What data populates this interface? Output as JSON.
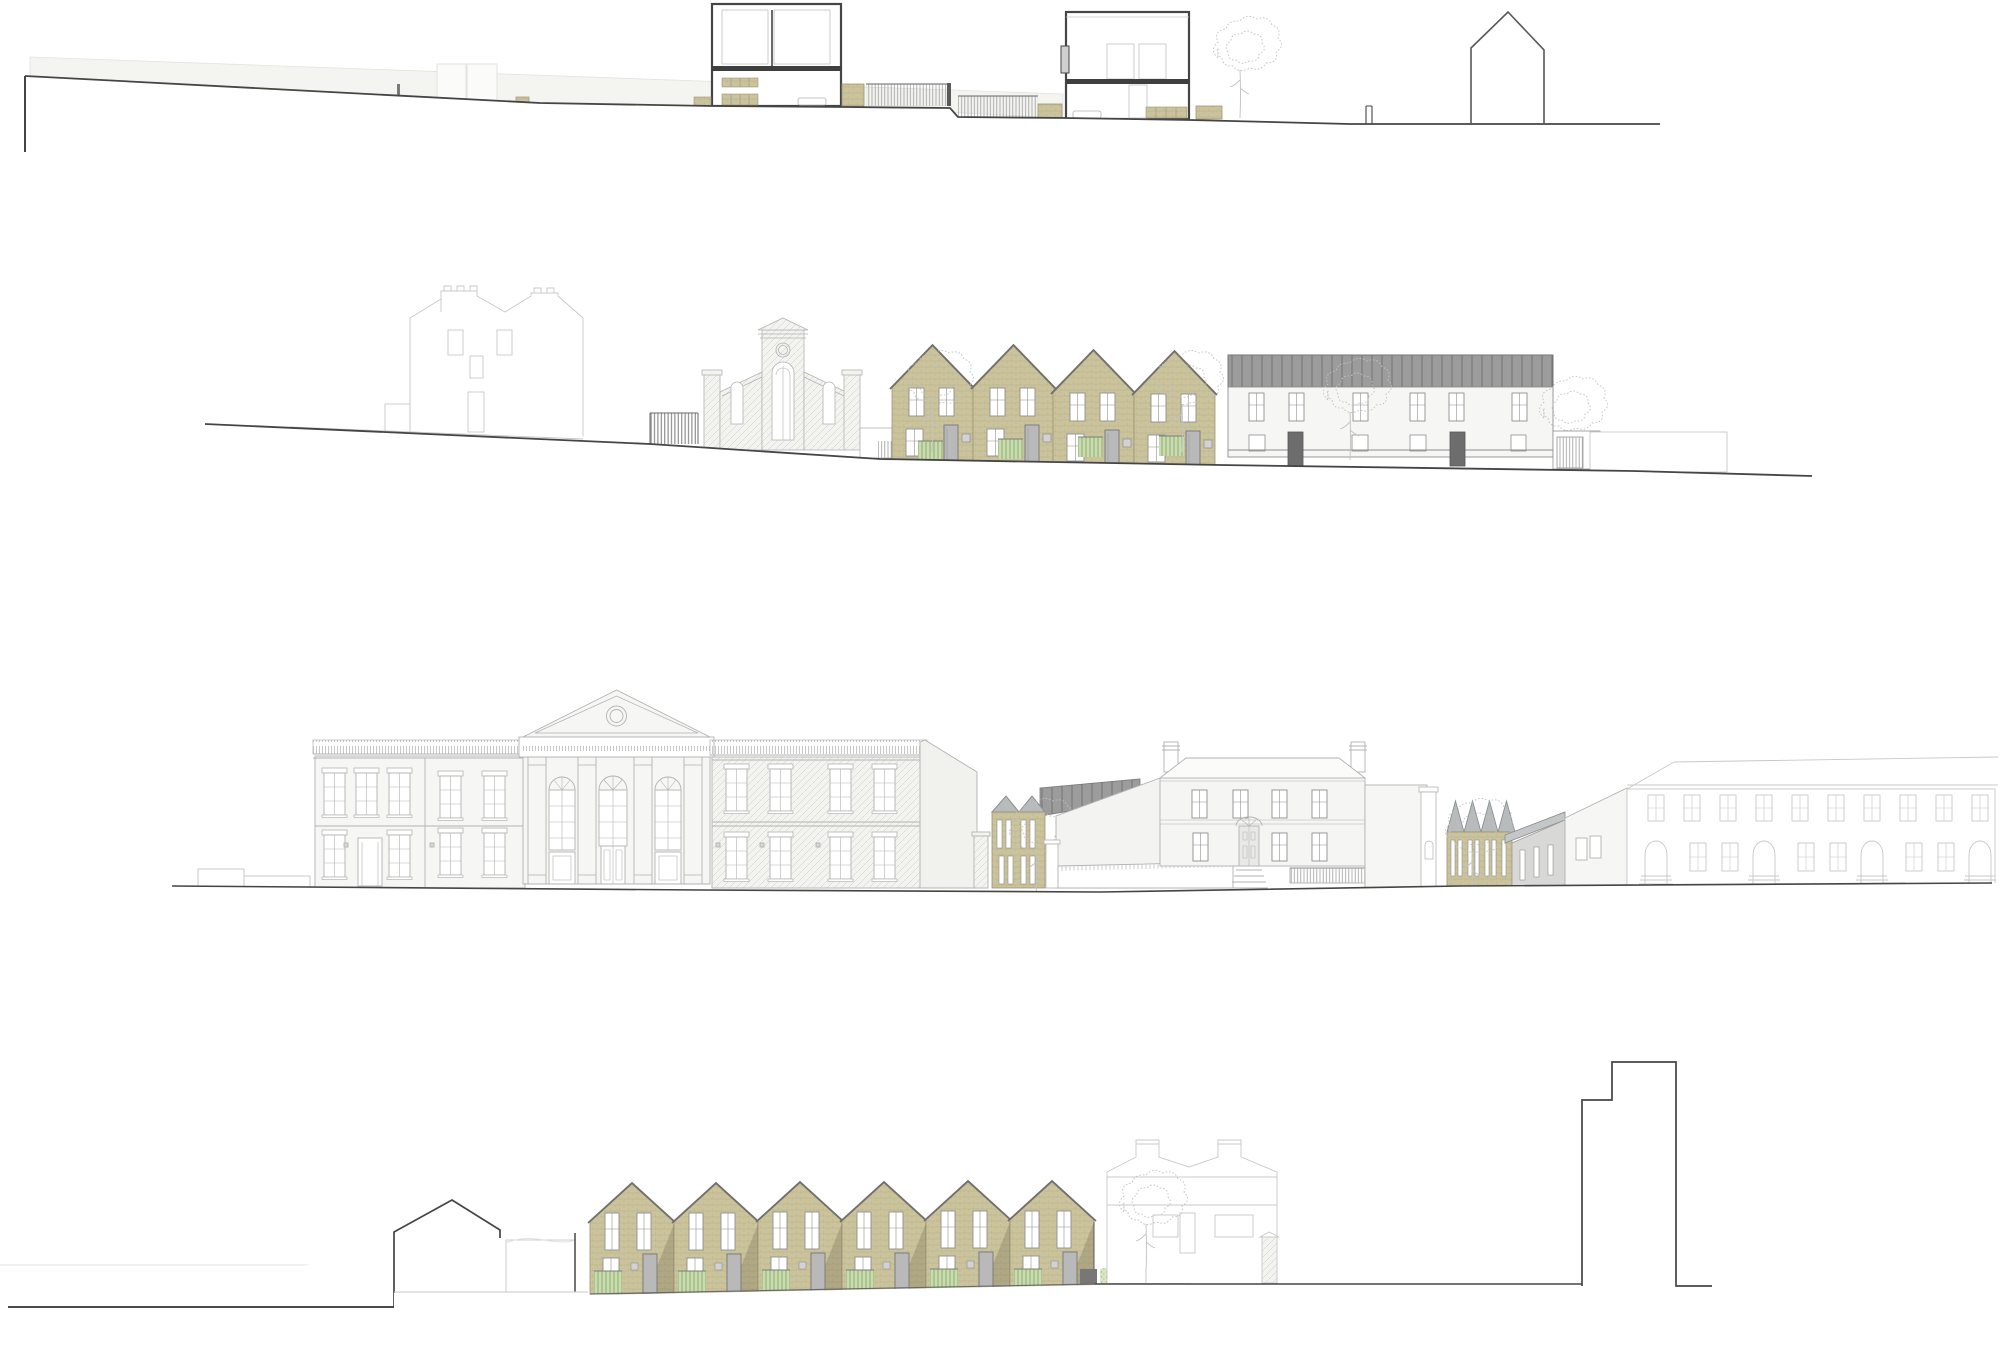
{
  "page": {
    "title": "Architectural drawing — four street elevations and site sections, proposed brick terraced housing within existing streetscape",
    "rows": [
      {
        "id": "site-section",
        "label": "Site section with two cross-sections through new houses, garden fences, planters, tree and adjacent gabled building outline"
      },
      {
        "id": "street-elevation-a",
        "label": "Street elevation: existing semi-detached house (faint), gate, former chapel (faint), four new gabled buff-brick houses with green slatted fences, existing white terrace with standing-seam roof, garden wall"
      },
      {
        "id": "street-elevation-b",
        "label": "Street elevation: Victorian terrace, classical portico chapel with pediment and oculus, stuccoed terrace, new buff-brick gabled infill, Georgian villa with railings, new sawtooth-roof brick block, long arched-door terrace"
      },
      {
        "id": "rear-elevation",
        "label": "Rear elevation: neighbour outline, six new gabled buff-brick houses with green slatted fences, hedge, existing house (faint), stepped adjacent building outline"
      }
    ],
    "new_build": {
      "street_terrace_houses": 4,
      "rear_terrace_houses": 6,
      "infill_gable_pair": 2,
      "sawtooth_roof_bays": 4
    }
  },
  "colors": {
    "paper": "#ffffff",
    "ink": "#454545",
    "mid": "#8f8f8f",
    "soft": "#b3b3b3",
    "ghost": "#c8c8c8",
    "faintLine": "#e2e2df",
    "faintFill": "#f4f4f1",
    "khaki": "#cbc39c",
    "khakiLine": "#a79e76",
    "khakiEdge": "#9d9577",
    "roofEdge": "#6f6f6f",
    "roofDark": "#9c9c9c",
    "seamLine": "#6e6e6e",
    "roofLight": "#b8bbbc",
    "roofLightLine": "#8a8f91",
    "greyWall": "#d8d8d7",
    "facadeWhite": "#f6f6f5",
    "hatchFill": "#f3f3f0",
    "hatchLine": "#c9c9c4",
    "green": "#c8dcae",
    "greenLine": "#8aa86e",
    "hedge": "#d7e7c2",
    "hedgeDot": "#a3c183",
    "doorGrey": "#b9b9b9",
    "slab": "#3f3f3f",
    "shadow": "rgba(95,88,58,0.25)",
    "fenceLine": "#9c9c9c",
    "fenceDark": "#7a7a7a",
    "treeLine": "#c2c2c2",
    "baluLine": "#b9b9b9"
  }
}
